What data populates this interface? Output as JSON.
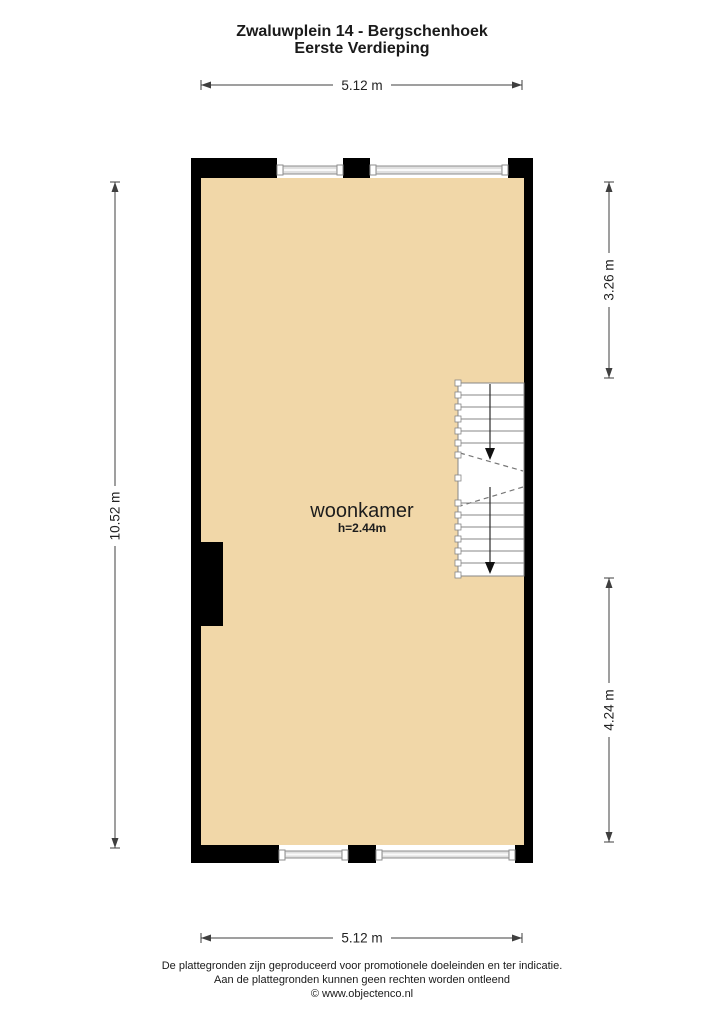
{
  "title": {
    "line1": "Zwaluwplein 14 - Bergschenhoek",
    "line2": "Eerste Verdieping"
  },
  "room": {
    "name": "woonkamer",
    "height": "h=2.44m"
  },
  "dimensions": {
    "width_top": "5.12 m",
    "width_bottom": "5.12 m",
    "height_left": "10.52 m",
    "right_upper": "3.26 m",
    "right_lower": "4.24 m"
  },
  "footer": {
    "line1": "De plattegronden zijn geproduceerd voor promotionele doeleinden en ter indicatie.",
    "line2": "Aan de plattegronden kunnen geen rechten worden ontleend",
    "line3": "© www.objectenco.nl"
  },
  "colors": {
    "floor": "#F1D7A8",
    "wall": "#000000",
    "window-line": "#8E8E8E",
    "stair-line": "#878787",
    "dim": "#3f3f3f"
  }
}
